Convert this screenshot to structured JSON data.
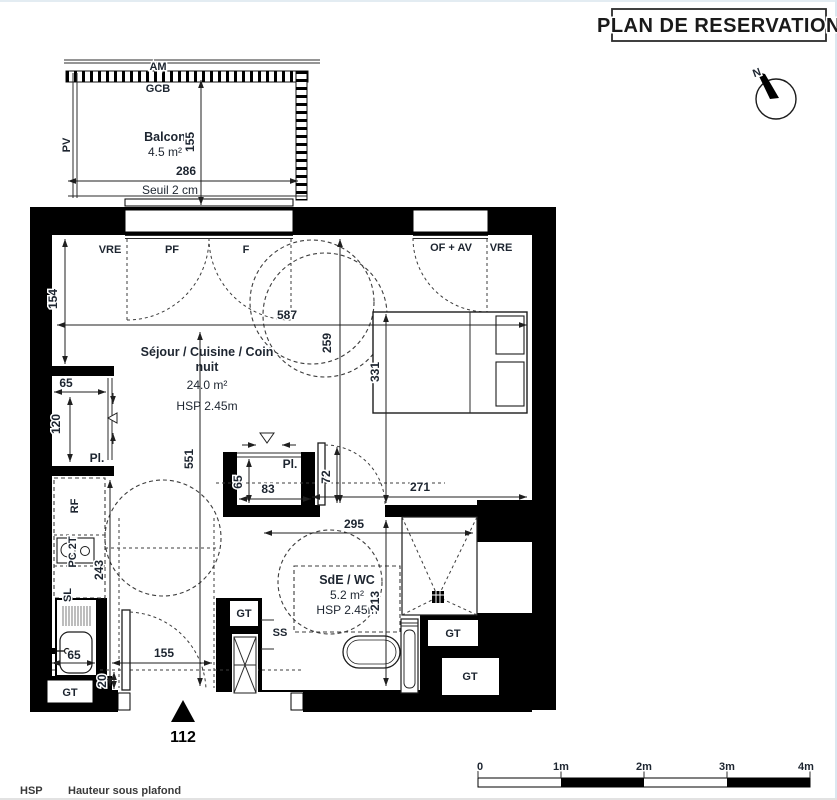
{
  "title": "PLAN DE RESERVATION",
  "compass": {
    "n": "N"
  },
  "balcony": {
    "am": "AM",
    "gcb": "GCB",
    "pv": "PV",
    "name": "Balcon",
    "area": "4.5 m²",
    "dim_depth": "155",
    "dim_width": "286",
    "seuil": "Seuil 2 cm"
  },
  "openings": {
    "vre_left": "VRE",
    "pf": "PF",
    "f": "F",
    "of_av": "OF + AV",
    "vre_right": "VRE"
  },
  "living": {
    "name1": "Séjour / Cuisine / Coin",
    "name2": "nuit",
    "area": "24.0 m²",
    "hsp": "HSP 2.45m"
  },
  "bathroom": {
    "name": "SdE / WC",
    "area": "5.2 m²",
    "hsp": "HSP 2.45m",
    "d295": "295",
    "d213": "213"
  },
  "closets": {
    "left": "Pl.",
    "mid": "Pl."
  },
  "kitchen": {
    "rf": "RF",
    "pc": "PC 2T",
    "sl": "SL",
    "d65_sink": "65",
    "d243": "243"
  },
  "fixtures": {
    "ss": "SS",
    "gt": "GT"
  },
  "dims": {
    "d587": "587",
    "d154": "154",
    "d259": "259",
    "d331": "331",
    "d551": "551",
    "d271": "271",
    "d72": "72",
    "d65_mid": "65",
    "d83": "83",
    "d65_left": "65",
    "d120": "120",
    "d155": "155",
    "d20": "20"
  },
  "entrance": {
    "door_dim": "112"
  },
  "scalebar": {
    "labels": [
      "0",
      "1m",
      "2m",
      "3m",
      "4m"
    ]
  },
  "legend": {
    "abbr": "HSP",
    "meaning": "Hauteur sous plafond"
  }
}
